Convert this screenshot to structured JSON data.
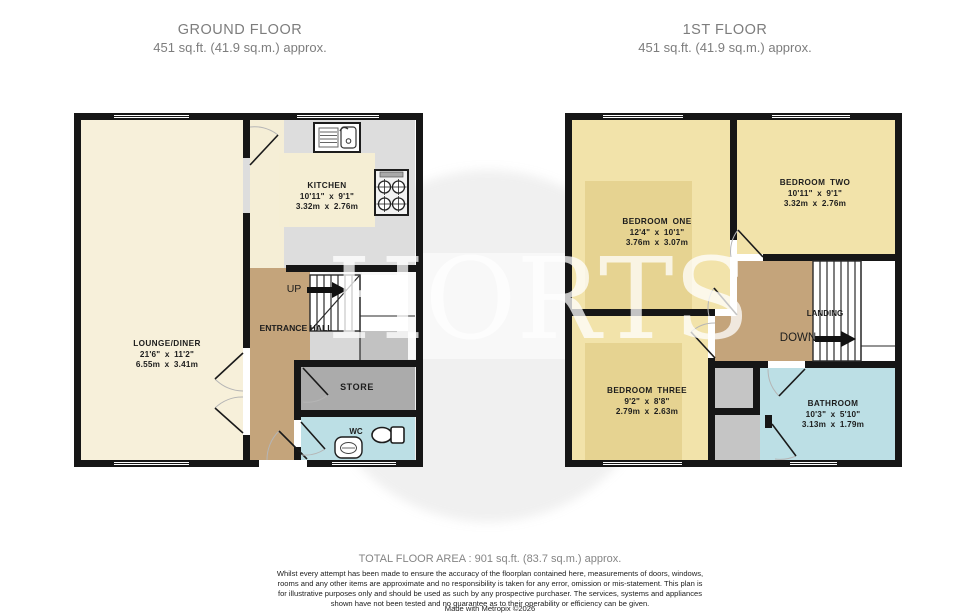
{
  "header": {
    "ground": {
      "title": "GROUND FLOOR",
      "subtitle": "451 sq.ft. (41.9 sq.m.) approx."
    },
    "first": {
      "title": "1ST FLOOR",
      "subtitle": "451 sq.ft. (41.9 sq.m.) approx."
    }
  },
  "watermark": {
    "text": "HORTS"
  },
  "ground": {
    "rooms": {
      "kitchen": {
        "name": "KITCHEN",
        "imperial": "10'11\" x 9'1\"",
        "metric": "3.32m x 2.76m"
      },
      "lounge": {
        "name": "LOUNGE/DINER",
        "imperial": "21'6\" x 11'2\"",
        "metric": "6.55m x 3.41m"
      },
      "hall": {
        "name": "ENTRANCE HALL"
      },
      "store": {
        "name": "STORE"
      },
      "wc": {
        "name": "WC"
      }
    },
    "stairs": {
      "up": "UP"
    }
  },
  "first": {
    "rooms": {
      "bedroom_one": {
        "name": "BEDROOM ONE",
        "imperial": "12'4\" x 10'1\"",
        "metric": "3.76m x 3.07m"
      },
      "bedroom_two": {
        "name": "BEDROOM TWO",
        "imperial": "10'11\" x 9'1\"",
        "metric": "3.32m x 2.76m"
      },
      "bedroom_three": {
        "name": "BEDROOM THREE",
        "imperial": "9'2\" x 8'8\"",
        "metric": "2.79m x 2.63m"
      },
      "bathroom": {
        "name": "BATHROOM",
        "imperial": "10'3\" x 5'10\"",
        "metric": "3.13m x 1.79m"
      },
      "landing": {
        "name": "LANDING"
      }
    },
    "stairs": {
      "down": "DOWN"
    }
  },
  "colors": {
    "wall": "#161616",
    "cream": "#F7F0DA",
    "kitchen_grey": "#DDDDDD",
    "rug_cream": "#F5EED4",
    "tan": "#C4A47B",
    "store_grey": "#ABABAB",
    "blue": "#BCDFE5",
    "bedroom_yellow": "#F2E3AA",
    "bedroom_rug": "#E6D391",
    "closet_grey": "#C5C5C5"
  },
  "footer": {
    "total": "TOTAL FLOOR AREA : 901 sq.ft. (83.7 sq.m.) approx.",
    "disclaimer": "Whilst every attempt has been made to ensure the accuracy of the floorplan contained here, measurements of doors, windows, rooms and any other items are approximate and no responsibility is taken for any error, omission or mis-statement. This plan is for illustrative purposes only and should be used as such by any prospective purchaser. The services, systems and appliances shown have not been tested and no guarantee as to their operability or efficiency can be given.",
    "credit": "Made with Metropix ©2026"
  }
}
